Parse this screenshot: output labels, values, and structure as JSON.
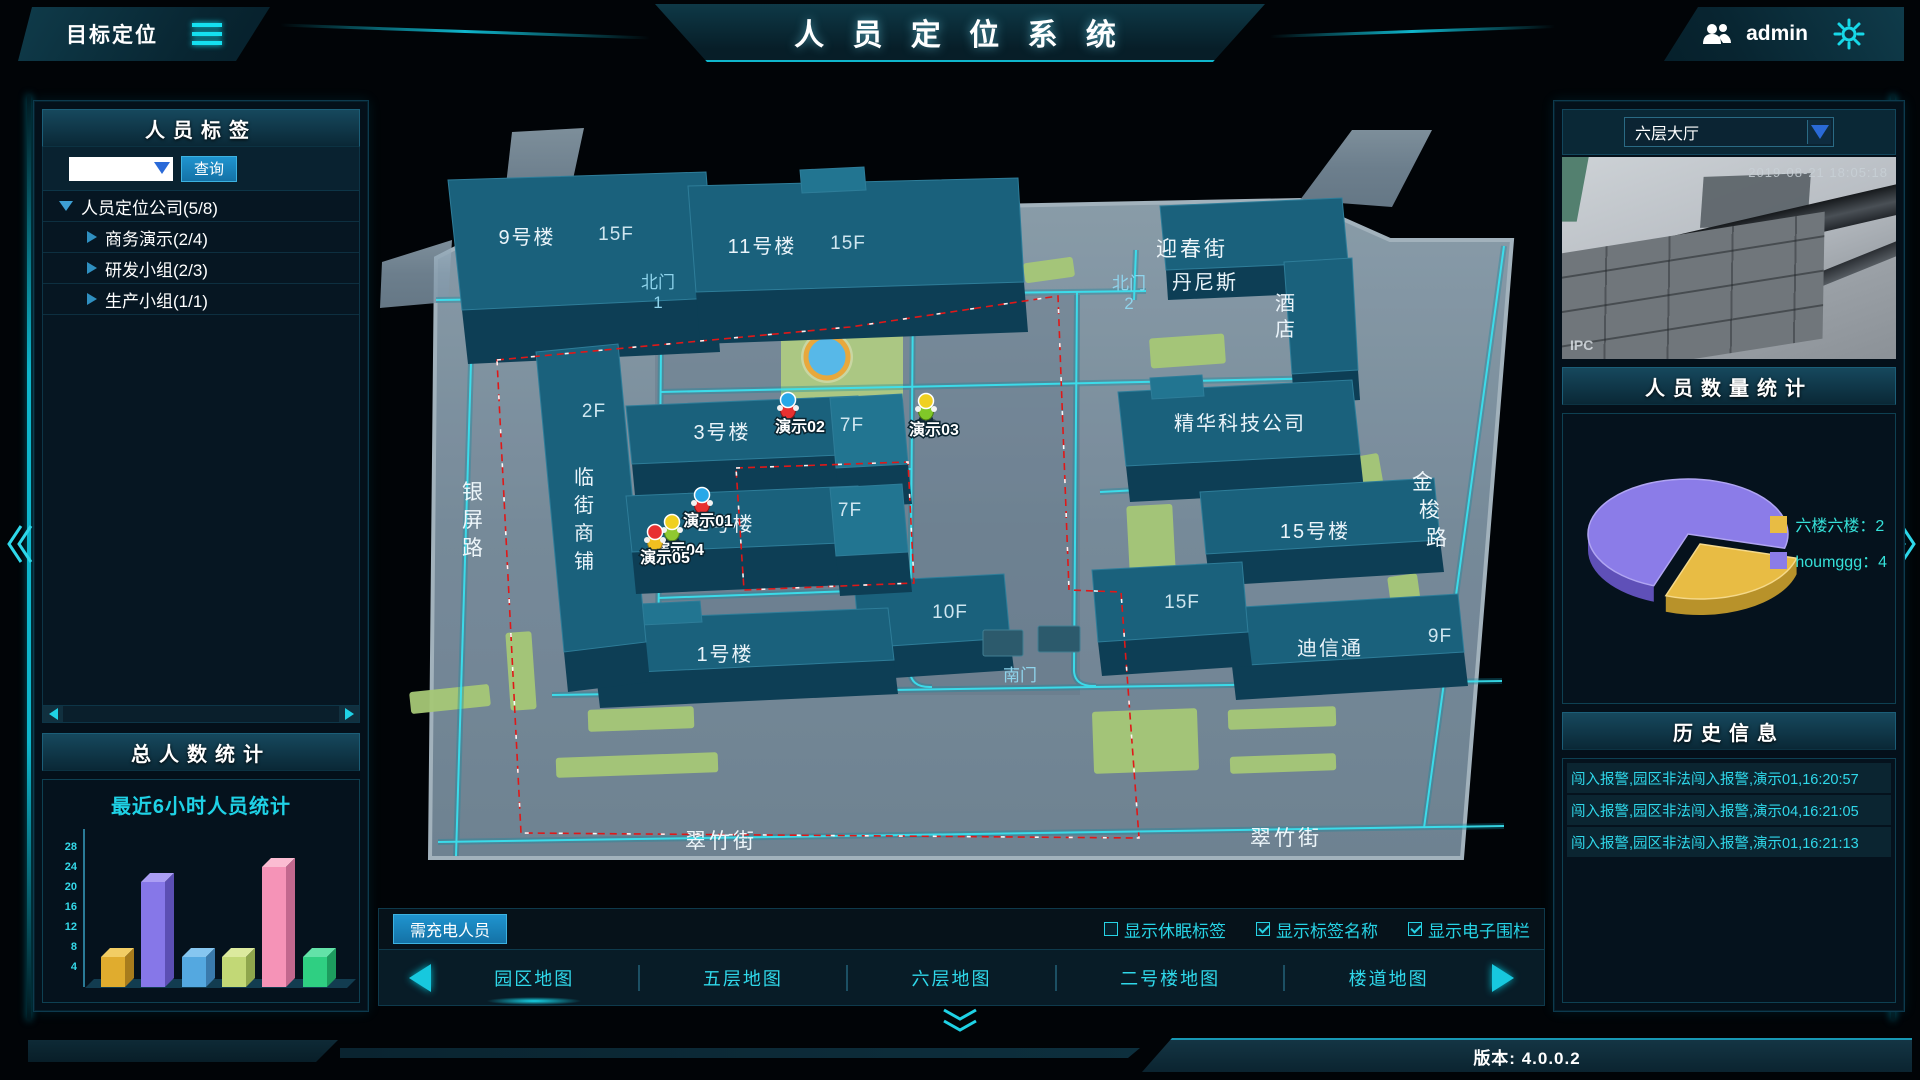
{
  "header": {
    "left_title": "目标定位",
    "title": "人 员 定 位 系 统",
    "user": "admin"
  },
  "left_panel": {
    "tags_title": "人员标签",
    "search_button": "查询",
    "tree": [
      {
        "label": "人员定位公司(5/8)",
        "level": 0,
        "expanded": true
      },
      {
        "label": "商务演示(2/4)",
        "level": 1,
        "expanded": false
      },
      {
        "label": "研发小组(2/3)",
        "level": 1,
        "expanded": false
      },
      {
        "label": "生产小组(1/1)",
        "level": 1,
        "expanded": false
      }
    ],
    "stats_title": "总人数统计",
    "chart_title": "最近6小时人员统计"
  },
  "chart_data": [
    {
      "type": "bar",
      "title": "最近6小时人员统计",
      "categories": [
        "",
        "",
        "",
        "",
        "",
        ""
      ],
      "values": [
        6,
        21,
        6,
        6,
        24,
        6
      ],
      "ylim": [
        0,
        30
      ],
      "yticks": [
        4,
        8,
        12,
        16,
        20,
        24,
        28
      ],
      "grid": false,
      "legend_position": "none",
      "bar_colors": [
        {
          "main": "#e0ac2e",
          "top": "#f2cd64",
          "side": "#a87c1c"
        },
        {
          "main": "#8677e8",
          "top": "#ab9ef4",
          "side": "#5c4fb4"
        },
        {
          "main": "#54a8e0",
          "top": "#86c6f0",
          "side": "#3a7aac"
        },
        {
          "main": "#c2d876",
          "top": "#dcea9e",
          "side": "#8fa64c"
        },
        {
          "main": "#f593b7",
          "top": "#fbbcd2",
          "side": "#c2688e"
        },
        {
          "main": "#2fcf82",
          "top": "#63e2a8",
          "side": "#1d9c5e"
        }
      ]
    },
    {
      "type": "pie",
      "title": "人员数量统计",
      "slices": [
        {
          "label": "六楼六楼",
          "value": 2,
          "color": "#e8bc44"
        },
        {
          "label": "houmggg",
          "value": 4,
          "color": "#8b7ce8"
        }
      ],
      "legend_position": "right"
    }
  ],
  "map": {
    "labels": [
      "9号楼",
      "15F",
      "11号楼",
      "15F",
      "迎春街",
      "北门",
      "1",
      "北门",
      "2",
      "丹尼斯",
      "酒",
      "店",
      "精华科技公司",
      "金",
      "梭",
      "路",
      "15号楼",
      "15F",
      "迪信通",
      "9F",
      "10F",
      "南门",
      "翠竹街",
      "翠竹街",
      "银",
      "屏",
      "路",
      "2F",
      "临",
      "街",
      "商",
      "铺",
      "3号楼",
      "7F",
      "2号楼",
      "7F",
      "1号楼"
    ],
    "persons": [
      {
        "name": "演示02"
      },
      {
        "name": "演示03"
      },
      {
        "name": "演示01"
      },
      {
        "name": "演示04"
      },
      {
        "name": "演示05"
      }
    ]
  },
  "bottom_bar": {
    "charge_button": "需充电人员",
    "checkboxes": [
      {
        "label": "显示休眠标签",
        "checked": false
      },
      {
        "label": "显示标签名称",
        "checked": true
      },
      {
        "label": "显示电子围栏",
        "checked": true
      }
    ],
    "tabs": [
      "园区地图",
      "五层地图",
      "六层地图",
      "二号楼地图",
      "楼道地图"
    ],
    "active_tab": "园区地图"
  },
  "right_panel": {
    "camera": {
      "selected": "六层大厅",
      "timestamp": "2019-08-21 18:05:18",
      "watermark": "IPC"
    },
    "count_title": "人员数量统计",
    "legend": [
      {
        "color": "#e8bc44",
        "text": "六楼六楼：2"
      },
      {
        "color": "#8b7ce8",
        "text": "houmggg：4"
      }
    ],
    "history_title": "历史信息",
    "history": [
      "闯入报警,园区非法闯入报警,演示01,16:20:57",
      "闯入报警,园区非法闯入报警,演示04,16:21:05",
      "闯入报警,园区非法闯入报警,演示01,16:21:13"
    ]
  },
  "footer": {
    "version": "版本: 4.0.0.2"
  }
}
